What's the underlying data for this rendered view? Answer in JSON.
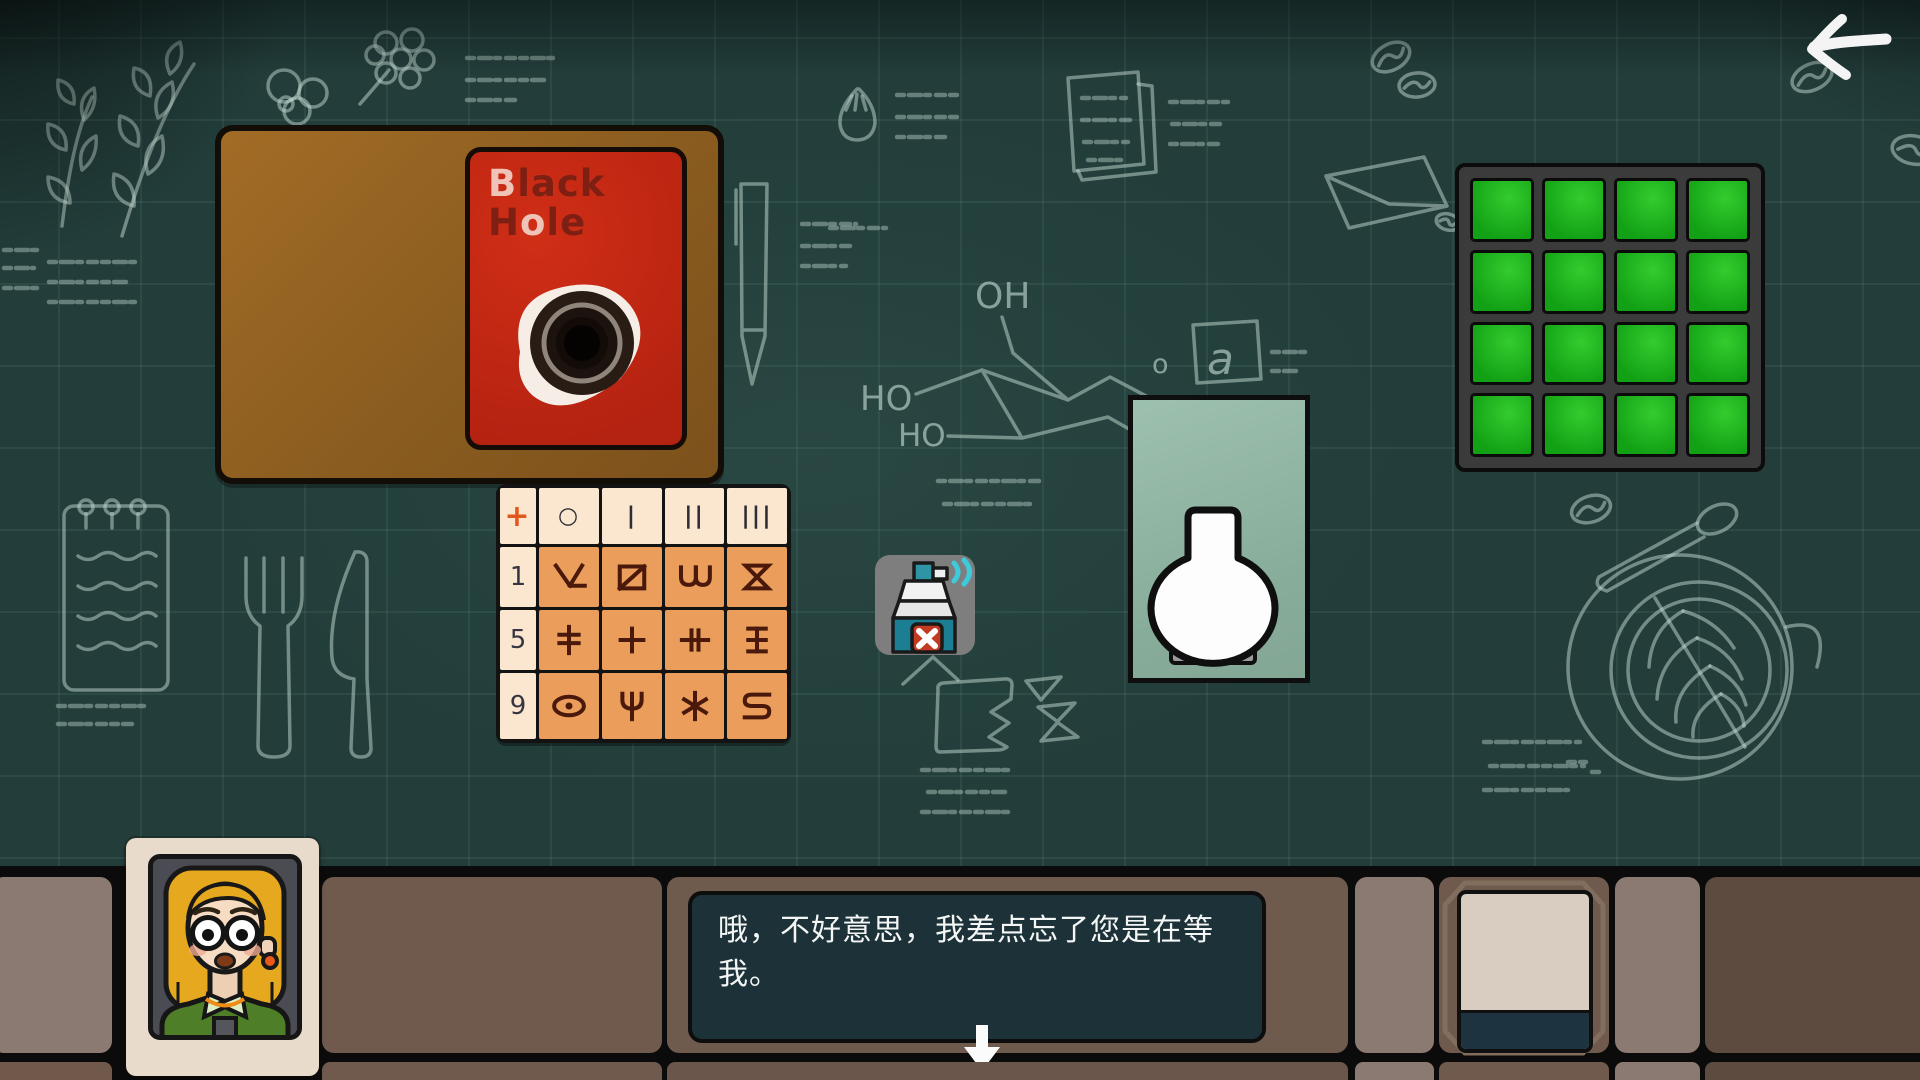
{
  "back_button": {
    "icon": "left-arrow"
  },
  "book": {
    "cover_title": "Black Hole",
    "segments": [
      {
        "text": "B",
        "tone": "light"
      },
      {
        "text": "lack",
        "tone": "dark"
      },
      {
        "text": "H",
        "tone": "dark"
      },
      {
        "text": "o",
        "tone": "light"
      },
      {
        "text": "le",
        "tone": "dark"
      }
    ]
  },
  "symbol_table": {
    "corner": "+",
    "headers": [
      "○",
      "|",
      "||",
      "|||"
    ],
    "rows": [
      {
        "label": "1",
        "cells": [
          "v-hook",
          "slashed-square",
          "double-u",
          "hourglass"
        ]
      },
      {
        "label": "5",
        "cells": [
          "double-bar-cross",
          "plus",
          "double-post-bar",
          "pillar-three-bar"
        ]
      },
      {
        "label": "9",
        "cells": [
          "eye",
          "trident-cup",
          "six-spoke-star",
          "square-s"
        ]
      }
    ]
  },
  "items": {
    "spray": {
      "name": "spray-bottle",
      "badge": "x-mark",
      "spray_color": "#3ec9dc"
    },
    "vase": {
      "name": "white-vase"
    },
    "note_card": {
      "state": "blank"
    }
  },
  "green_grid": {
    "rows": 4,
    "cols": 4,
    "on_color": "#12a014",
    "cells": [
      "on",
      "on",
      "on",
      "on",
      "on",
      "on",
      "on",
      "on",
      "on",
      "on",
      "on",
      "on",
      "on",
      "on",
      "on",
      "on"
    ]
  },
  "dialogue": {
    "text": "哦，不好意思，我差点忘了您是在等我。",
    "advance_icon": "down-arrow"
  },
  "portrait": {
    "character": "blonde woman with round glasses"
  },
  "chalk": {
    "oh": "OH",
    "ho1": "HO",
    "ho2": "HO",
    "boxed_letter": "a",
    "small_o": "o"
  },
  "colors": {
    "board": "#8a5c1f",
    "book_red": "#c32511",
    "table_orange": "#eb9e5c",
    "table_cream": "#fbe7cf",
    "grid_green": "#12a014",
    "dialogue_bg": "#1d3139"
  }
}
